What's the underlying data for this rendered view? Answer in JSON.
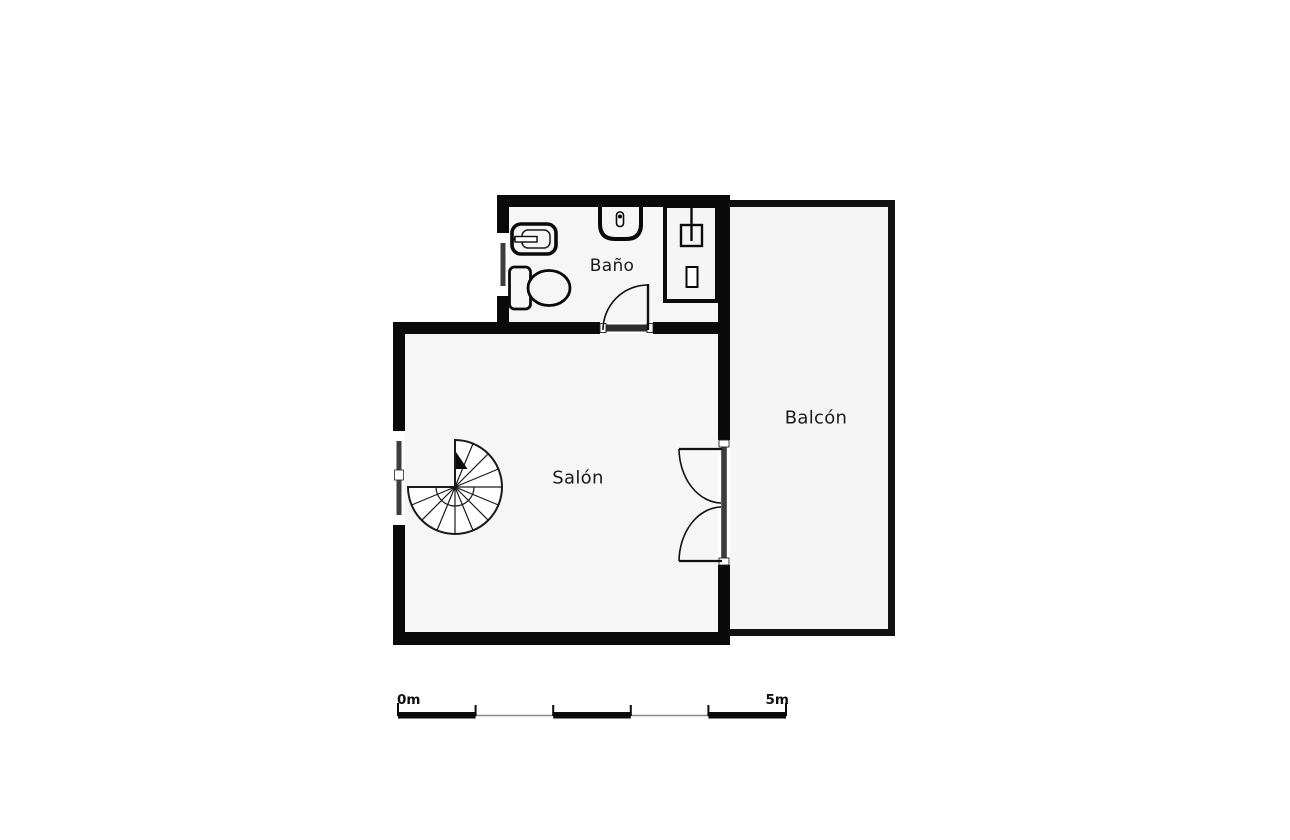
{
  "plan_title": "Apartment floor plan",
  "rooms": [
    {
      "id": "bano",
      "label": "Baño"
    },
    {
      "id": "salon",
      "label": "Salón"
    },
    {
      "id": "balcon",
      "label": "Balcón"
    }
  ],
  "scale_bar": {
    "start_label": "0m",
    "end_label": "5m",
    "segments": 5,
    "meters_total": 5
  },
  "fixtures": [
    "spiral-staircase",
    "bidet",
    "toilet",
    "washbasin",
    "shower",
    "single-swing-door",
    "double-swing-door",
    "window-salon",
    "window-bano"
  ],
  "colors": {
    "wall": "#0a0a0a",
    "room_floor": "#f6f6f6",
    "balcony_floor": "#f5f5f5",
    "glazing": "#3d3d3d",
    "threshold": "#2e2e2e",
    "page_background": "#ffffff",
    "label_text": "#1a1a1a",
    "scale_baseline": "#888888"
  }
}
